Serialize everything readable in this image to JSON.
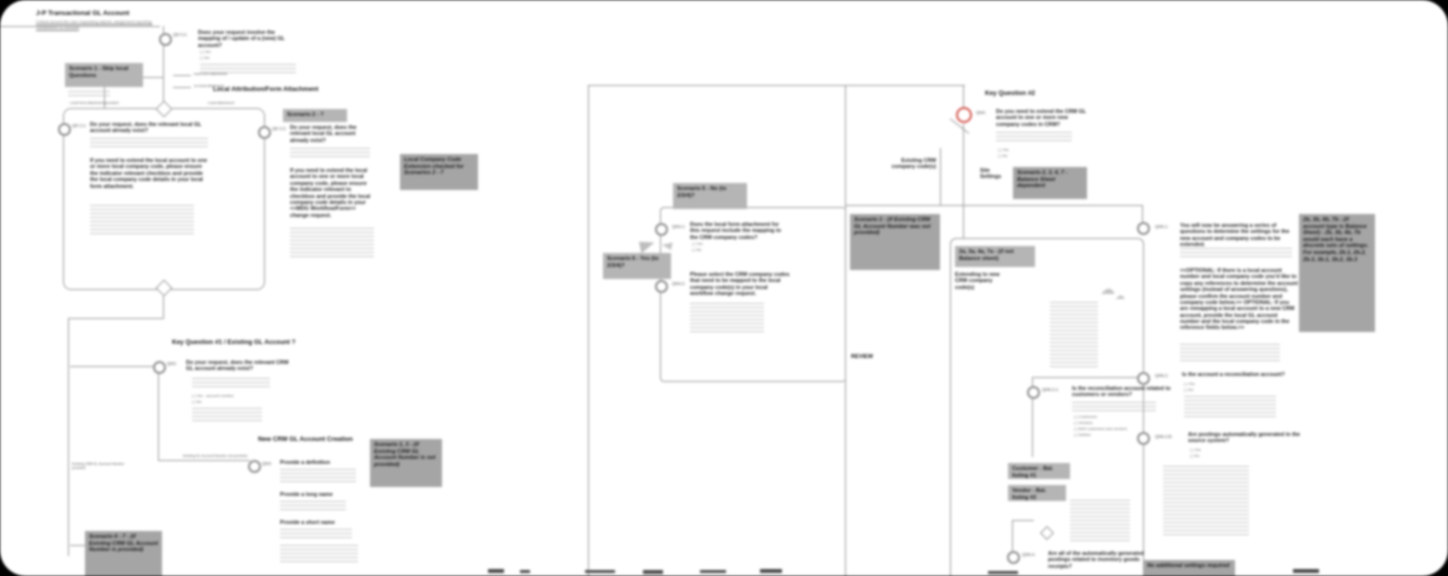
{
  "title": {
    "main": "J-P Transactional GL Account",
    "sub": "Criteria around the user requesting objects, assignment reporting; Streamlined GL Account"
  },
  "headers": {
    "local_attachment": "Local Attribution/Form Attachment",
    "kq1": "Key Question #1 / Existing GL Account ?",
    "new_account": "New CRM GL Account Creation",
    "kq2": "Key Question #2"
  },
  "labels": {
    "existing_code": "Existing CRM company code(s)",
    "site_settings": "Site Settings",
    "review": "REVIEW",
    "stub1": "local form attachment",
    "stub2": "no local attachment",
    "conn_a_left": "Local form attachment provided",
    "conn_a_right": "Local attachment",
    "conn_qn3": "Existing GL Account Number not provided",
    "conn_s47": "Existing CRM GL Account Number provided",
    "extending": "Extending to new CRM company code(s)"
  },
  "boxes": {
    "scenario1": "Scenario 1 - Skip local Questions",
    "scenario2": "Scenario 2 - ?",
    "local_cc_ext": "Local Company Code Extension checked for Scenarios 2 - 7",
    "scenario13": "Scenario 1, 3 - (if Existing CRM GL Account Number is not provided)",
    "scenario47": "Scenario 4 - 7 - (if Existing CRM GL Account Number is provided)",
    "scenario5": "Scenario 5 - No (to 2/3/4)?",
    "scenario6": "Scenario 6 - Yes (to 2/3/4)?",
    "scenario1_mid": "Scenario 1 - (if Existing CRM GL Account Number was not provided)",
    "scenario2347": "Scenario 2, 3, 4, 7 - Balance Sheet dependent",
    "a_not_bs": "2a, 3a, 4a, 7a - (if not Balance sheet)",
    "b_bs": "2b, 3b, 4b, 7b - (if account type is Balance Sheet) - 2b, 3b, 4b, 7b would each have a discrete sets of settings. For example, 2b.1, 2b.2, 2b.3, 3b.1, 3b.2, 3b.3",
    "b_note": "Note: It is possible to arrive at this same settings even when different answers are provided. (See #2.1 and #2.2, #4.1, and #4.2)",
    "customer_listing": "Customer - Bal. listing #1",
    "vendor_listing": "Vendor - Bal. listing #2",
    "bottom_cut": "No additional settings required"
  },
  "nodes": {
    "qn01": {
      "label": "QN 0.1:",
      "q": "Does your request involve the mapping of / update of a (new) GL account?",
      "opt1": "( ) Yes",
      "opt2": "( ) No"
    },
    "qn21": {
      "label": "QN 2.1:",
      "q": "Do your request, does the relevant local GL account already exist?",
      "para": "If you need to extend the local account to one or more local company code, please ensure the indicator relevant checkbox and provide the local company code details in your local form attachment."
    },
    "qn22": {
      "label": "QN 2.2:",
      "q": "Do your request, does the relevant local GL account already exist?",
      "para": "If you need to extend the local account to one or more local company code, please ensure the indicator relevant to checkbox and provide the local company code details in your <<MDG Workflow/Form>> change request."
    },
    "qn2": {
      "label": "QN2:",
      "q": "Do your request, does the relevant CRM GL account already exist?",
      "opt1": "( ) Yes - account number:",
      "opt2": "( ) No"
    },
    "qn3": {
      "label": "QN3:",
      "item1": "Provide a definition",
      "item2": "Provide a long name",
      "item3": "Provide a short name"
    },
    "qn4": {
      "label": "QN4:",
      "q": "Do you need to extend the CRM GL account to one or more new company codes in CRM?",
      "opt1": "( ) Yes",
      "opt2": "( ) No"
    },
    "qn41": {
      "label": "QN4.1:",
      "q": "Does the local form attachment for this request include the mapping to the CRM company codes?",
      "opt1": "( ) Yes",
      "opt2": "( ) No"
    },
    "qn42": {
      "label": "QN4.2:",
      "q": "Please select the CRM company codes that need to be mapped to the local company code(s) in your local workflow change request."
    },
    "qn61": {
      "label": "QN6.1:",
      "q": "You will now be answering a series of questions to determine the settings for the new account and company codes to be extended.",
      "para": "<<OPTIONAL: If there is a local account number and local company code you'd like to copy any references to determine the account settings (instead of answering questions), please confirm the account number and company code below.>> OPTIONAL: If you are remapping a local account to a new CRM account, provide the local GL account number and the local company code in the reference fields below.>>"
    },
    "qn62": {
      "label": "QN6.2:",
      "q": "Is the account a reconciliation account?",
      "opt1": "( ) Yes",
      "opt2": "( ) No"
    },
    "qn62b": {
      "label": "QN6.2.B:",
      "q": "Are postings automatically generated in the source system?",
      "opt1": "( ) Yes",
      "opt2": "( ) No"
    },
    "qn621": {
      "label": "QN6.2.1:",
      "q": "Is the reconciliation account related to customers or vendors?",
      "opts": [
        "( ) Customers",
        "( ) Vendors",
        "( ) Both customers and vendors",
        "( ) Neither"
      ]
    },
    "qn64": {
      "label": "QN6.4:",
      "q": "Are all of the automatically generated postings related to inventory goods receipts?"
    }
  },
  "colors": {
    "accent_red": "#d4574e",
    "box_light": "#b5b5b5",
    "box_dark": "#a5a5a5",
    "line": "#9b9b9b"
  }
}
